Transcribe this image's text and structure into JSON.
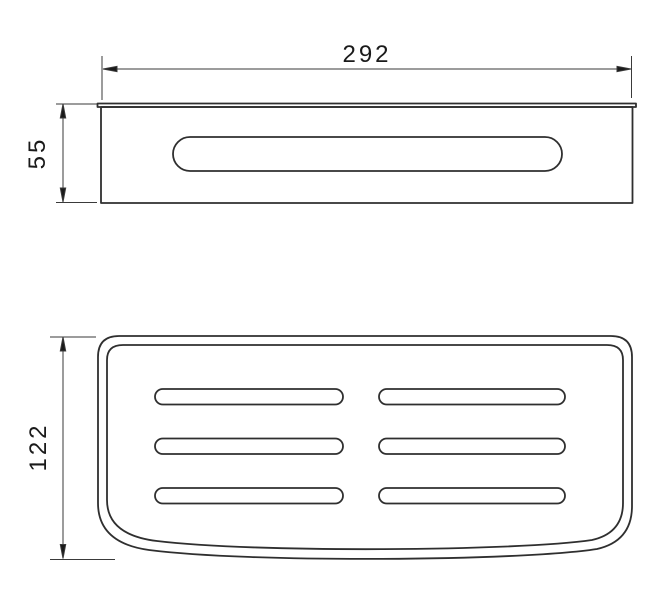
{
  "dimensions": {
    "width": "292",
    "height": "55",
    "depth": "122"
  },
  "colors": {
    "outline": "#2f2f2f",
    "dimension": "#3a3a3a",
    "background": "#ffffff"
  }
}
